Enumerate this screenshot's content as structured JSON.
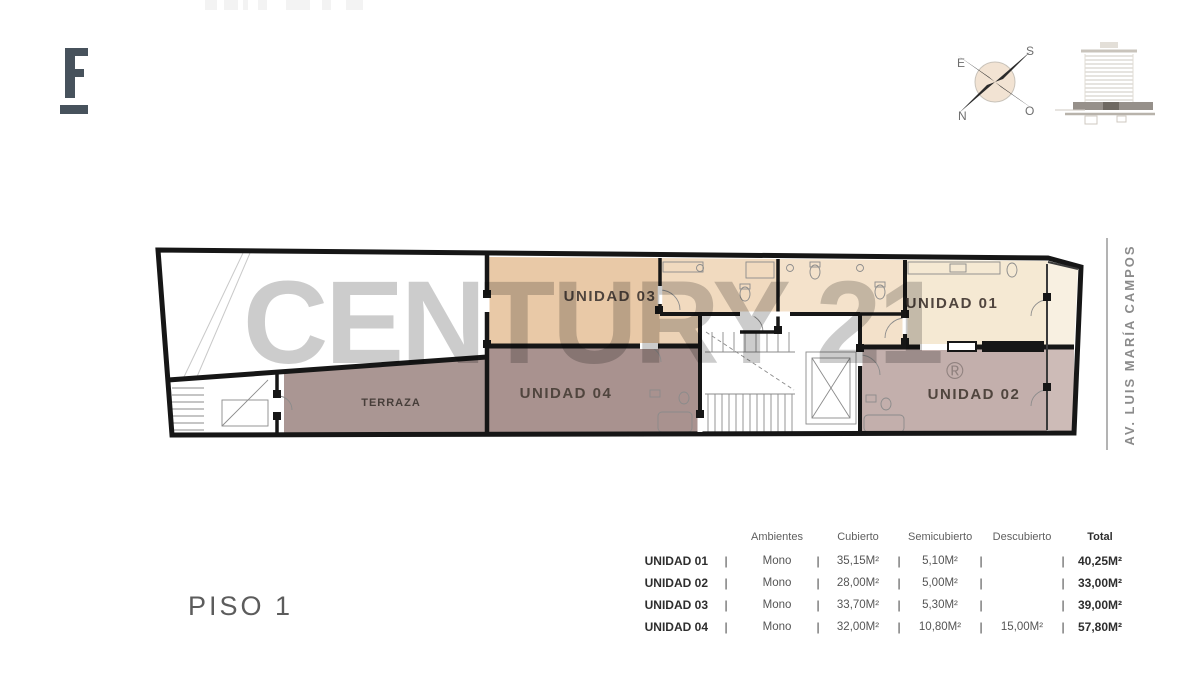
{
  "watermark": {
    "text": "CENTURY 21",
    "registered": "®"
  },
  "compass": {
    "top_left": "E",
    "top_right": "S",
    "bottom_left": "N",
    "bottom_right": "O"
  },
  "plan": {
    "street_label": "AV. LUIS MARÍA CAMPOS",
    "units": [
      {
        "label": "UNIDAD 01",
        "color": "#f5e9d3"
      },
      {
        "label": "UNIDAD 02",
        "color": "#c3afac"
      },
      {
        "label": "UNIDAD 03",
        "color": "#e9c9a7"
      },
      {
        "label": "UNIDAD 04",
        "color": "#a9928f"
      },
      {
        "label": "TERRAZA",
        "color": "#aa9693"
      }
    ]
  },
  "floor_label": "PISO 1",
  "table": {
    "separator": "|",
    "headers": [
      "Ambientes",
      "Cubierto",
      "Semicubierto",
      "Descubierto",
      "Total"
    ],
    "rows": [
      {
        "unit": "UNIDAD 01",
        "ambientes": "Mono",
        "cubierto": "35,15M²",
        "semicubierto": "5,10M²",
        "descubierto": "",
        "total": "40,25M²"
      },
      {
        "unit": "UNIDAD 02",
        "ambientes": "Mono",
        "cubierto": "28,00M²",
        "semicubierto": "5,00M²",
        "descubierto": "",
        "total": "33,00M²"
      },
      {
        "unit": "UNIDAD 03",
        "ambientes": "Mono",
        "cubierto": "33,70M²",
        "semicubierto": "5,30M²",
        "descubierto": "",
        "total": "39,00M²"
      },
      {
        "unit": "UNIDAD 04",
        "ambientes": "Mono",
        "cubierto": "32,00M²",
        "semicubierto": "10,80M²",
        "descubierto": "15,00M²",
        "total": "57,80M²"
      }
    ]
  }
}
